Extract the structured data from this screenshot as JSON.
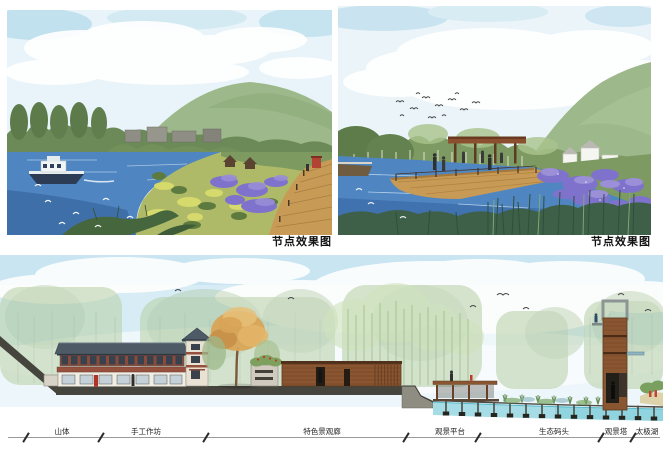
{
  "captions": {
    "render_left": "节点效果图",
    "render_right": "节点效果图"
  },
  "section": {
    "labels": [
      {
        "id": "mountain",
        "text": "山体"
      },
      {
        "id": "workshop",
        "text": "手工作坊"
      },
      {
        "id": "gallery",
        "text": "特色景观廊"
      },
      {
        "id": "platform",
        "text": "观景平台"
      },
      {
        "id": "dock",
        "text": "生态码头"
      },
      {
        "id": "tower",
        "text": "观景塔"
      },
      {
        "id": "lake",
        "text": "太极湖"
      }
    ]
  },
  "colors": {
    "water_blue": "#4f86c2",
    "iris_purple": "#7f72cc",
    "mountain_green": "#9db88a",
    "marsh_green": "#aeba68",
    "deck_wood": "#c79a55",
    "corten_brown": "#8a5531",
    "roof_slate": "#4e5a66",
    "section_water": "#a5dce6",
    "ground_dark": "#45443d"
  }
}
